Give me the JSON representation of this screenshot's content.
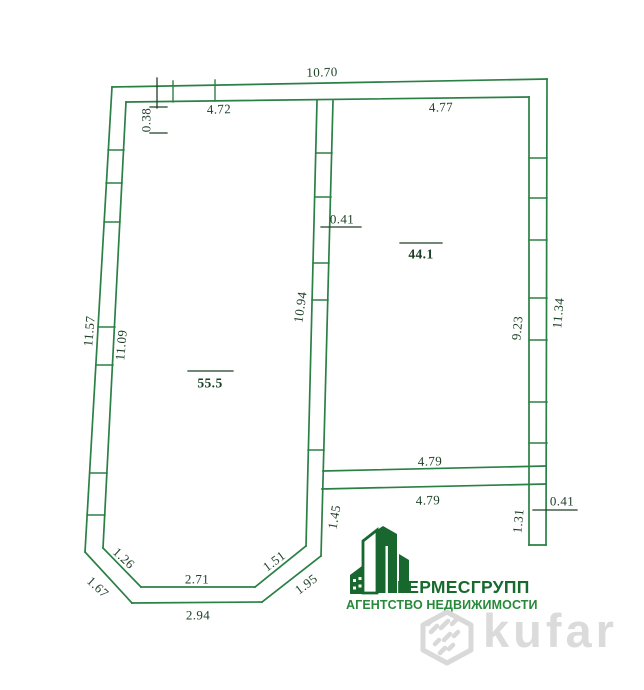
{
  "plan": {
    "dims": {
      "top_total": "10.70",
      "top_left_room": "4.72",
      "top_right_room": "4.77",
      "top_wall_thickness": "0.38",
      "left_outer": "11.57",
      "left_inner": "11.09",
      "middle_wall_length": "10.94",
      "middle_wall_thickness": "0.41",
      "right_inner": "9.23",
      "right_outer": "11.34",
      "partition_top": "4.79",
      "partition_bottom": "4.79",
      "right_wall_thickness": "0.41",
      "right_wall_stub": "1.31",
      "middle_wall_stub": "1.45",
      "chamfer_left_inner": "1.26",
      "chamfer_left_outer": "1.67",
      "bottom_inner": "2.71",
      "bottom_outer": "2.94",
      "chamfer_right_inner": "1.51",
      "chamfer_right_outer": "1.95"
    },
    "areas": {
      "left_room": "55.5",
      "right_room": "44.1"
    }
  },
  "logo": {
    "company": "ГЕРМЕСГРУПП",
    "tagline": "АГЕНТСТВО НЕДВИЖИМОСТИ"
  },
  "watermark": {
    "brand": "kufar"
  },
  "colors": {
    "wall_line": "#2b8045",
    "dimension_text": "#1d4026",
    "logo_primary": "#17672e",
    "logo_secondary": "#27893a",
    "watermark_gray": "#d9d9d9"
  }
}
